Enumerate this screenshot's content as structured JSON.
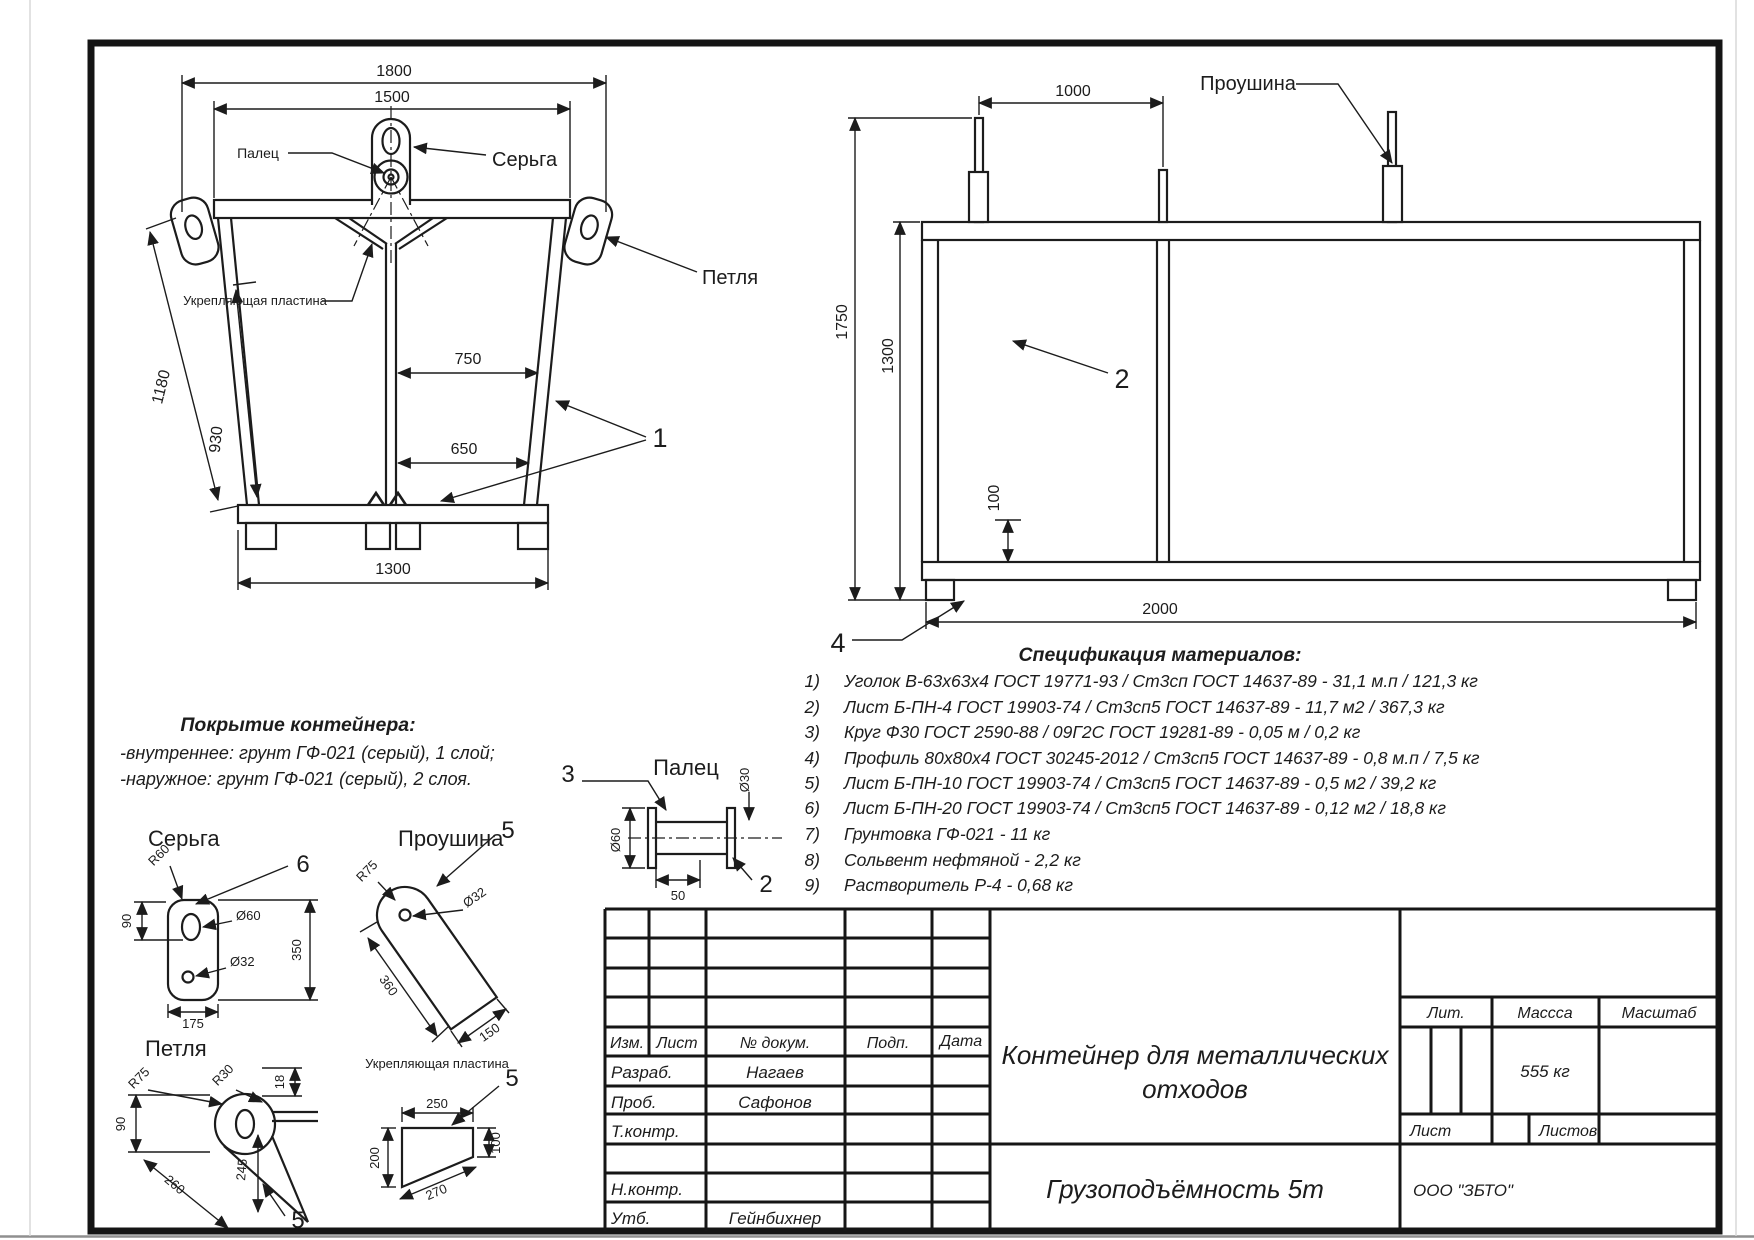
{
  "sheet": {
    "spec": {
      "title": "Спецификация материалов:",
      "items": [
        {
          "num": "1)",
          "text": "Уголок В-63х63х4 ГОСТ 19771-93 / Ст3сп ГОСТ 14637-89 - 31,1 м.п / 121,3 кг"
        },
        {
          "num": "2)",
          "text": "Лист Б-ПН-4 ГОСТ 19903-74 / Ст3сп5 ГОСТ 14637-89 - 11,7 м2 / 367,3 кг"
        },
        {
          "num": "3)",
          "text": "Круг Ф30 ГОСТ 2590-88 / 09Г2С ГОСТ 19281-89 - 0,05 м / 0,2 кг"
        },
        {
          "num": "4)",
          "text": "Профиль 80х80х4 ГОСТ 30245-2012 / Ст3сп5 ГОСТ 14637-89 - 0,8 м.п / 7,5 кг"
        },
        {
          "num": "5)",
          "text": "Лист Б-ПН-10 ГОСТ 19903-74 / Ст3сп5 ГОСТ 14637-89 - 0,5 м2 / 39,2 кг"
        },
        {
          "num": "6)",
          "text": "Лист Б-ПН-20 ГОСТ 19903-74 / Ст3сп5 ГОСТ 14637-89 - 0,12 м2 / 18,8 кг"
        },
        {
          "num": "7)",
          "text": "Грунтовка ГФ-021 - 11 кг"
        },
        {
          "num": "8)",
          "text": "Сольвент нефтяной - 2,2 кг"
        },
        {
          "num": "9)",
          "text": "Растворитель Р-4 - 0,68 кг"
        }
      ]
    },
    "coating": {
      "title": "Покрытие контейнера:",
      "line1": "-внутреннее: грунт ГФ-021 (серый), 1 слой;",
      "line2": "-наружное: грунт ГФ-021 (серый), 2 слоя."
    },
    "front_view": {
      "dim_1800": "1800",
      "dim_1500": "1500",
      "dim_750": "750",
      "dim_650": "650",
      "dim_1300": "1300",
      "dim_1180": "1180",
      "dim_930": "930",
      "label_palec": "Палец",
      "label_serga": "Серьга",
      "label_petlya": "Петля",
      "label_plate": "Укрепляющая пластина",
      "callout_1": "1"
    },
    "side_view": {
      "dim_1000": "1000",
      "dim_1750": "1750",
      "dim_1300": "1300",
      "dim_100": "100",
      "dim_2000": "2000",
      "label_proushina": "Проушина",
      "callout_2": "2",
      "callout_4": "4"
    },
    "details": {
      "serga": {
        "title": "Серьга",
        "callout": "6",
        "r60": "R60",
        "dia60": "Ø60",
        "dia32": "Ø32",
        "d90": "90",
        "d350": "350",
        "d175": "175"
      },
      "proushina": {
        "title": "Проушина",
        "callout": "5",
        "r75": "R75",
        "dia32": "Ø32",
        "d360": "360",
        "d150": "150"
      },
      "petlya": {
        "title": "Петля",
        "callout": "5",
        "r75": "R75",
        "r30": "R30",
        "d18": "18",
        "d90": "90",
        "d245": "245",
        "d260": "260"
      },
      "plate": {
        "title": "Укрепляющая пластина",
        "callout": "5",
        "d250": "250",
        "d200": "200",
        "d100": "100",
        "d270": "270"
      },
      "palec": {
        "title": "Палец",
        "callout_3": "3",
        "callout_2": "2",
        "dia30": "Ø30",
        "dia60": "Ø60",
        "d50": "50"
      }
    },
    "title_block": {
      "cols": {
        "izm": "Изм.",
        "list": "Лист",
        "doc": "№ докум.",
        "podp": "Подп.",
        "data": "Дата"
      },
      "rows": {
        "razrab": "Разраб.",
        "prob": "Проб.",
        "tkontr": "Т.контр.",
        "nkontr": "Н.контр.",
        "utv": "Утб."
      },
      "names": {
        "razrab": "Нагаев",
        "prob": "Сафонов",
        "utv": "Гейнбихнер"
      },
      "title_line1": "Контейнер для металлических",
      "title_line2": "отходов",
      "lit": "Лит.",
      "mass": "Массса",
      "scale": "Масштаб",
      "mass_value": "555 кг",
      "sheet": "Лист",
      "sheets": "Листов",
      "capacity": "Грузоподъёмность 5т",
      "company": "ООО \"ЗБТО\""
    }
  }
}
